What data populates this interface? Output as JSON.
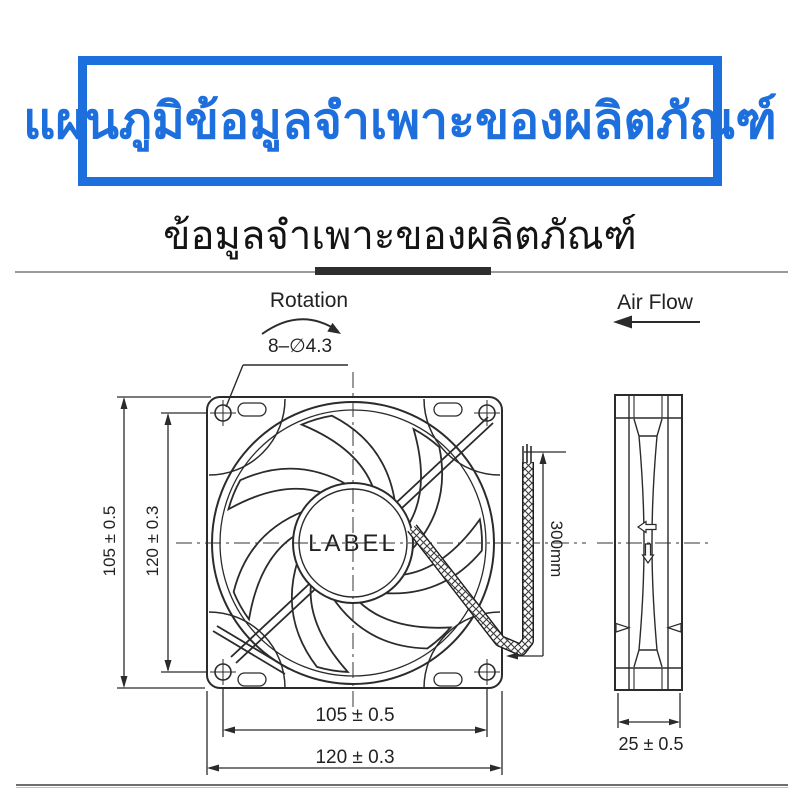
{
  "header": {
    "title": "แผนภูมิข้อมูลจำเพาะของผลิตภัณฑ์",
    "accent_color": "#1d6fdd"
  },
  "section": {
    "subtitle": "ข้อมูลจำเพาะของผลิตภัณฑ์"
  },
  "diagram": {
    "line_color": "#2b2b2b",
    "rotation_label": "Rotation",
    "holes_label": "8–∅4.3",
    "airflow_label": "Air Flow",
    "fan_label": "LABEL",
    "wire_length": "300mm",
    "front_view": {
      "height_outer": "105 ± 0.5",
      "height_inner": "120 ± 0.3",
      "width_holes": "105 ± 0.5",
      "width_frame": "120 ± 0.3"
    },
    "side_view": {
      "depth": "25 ± 0.5"
    }
  }
}
